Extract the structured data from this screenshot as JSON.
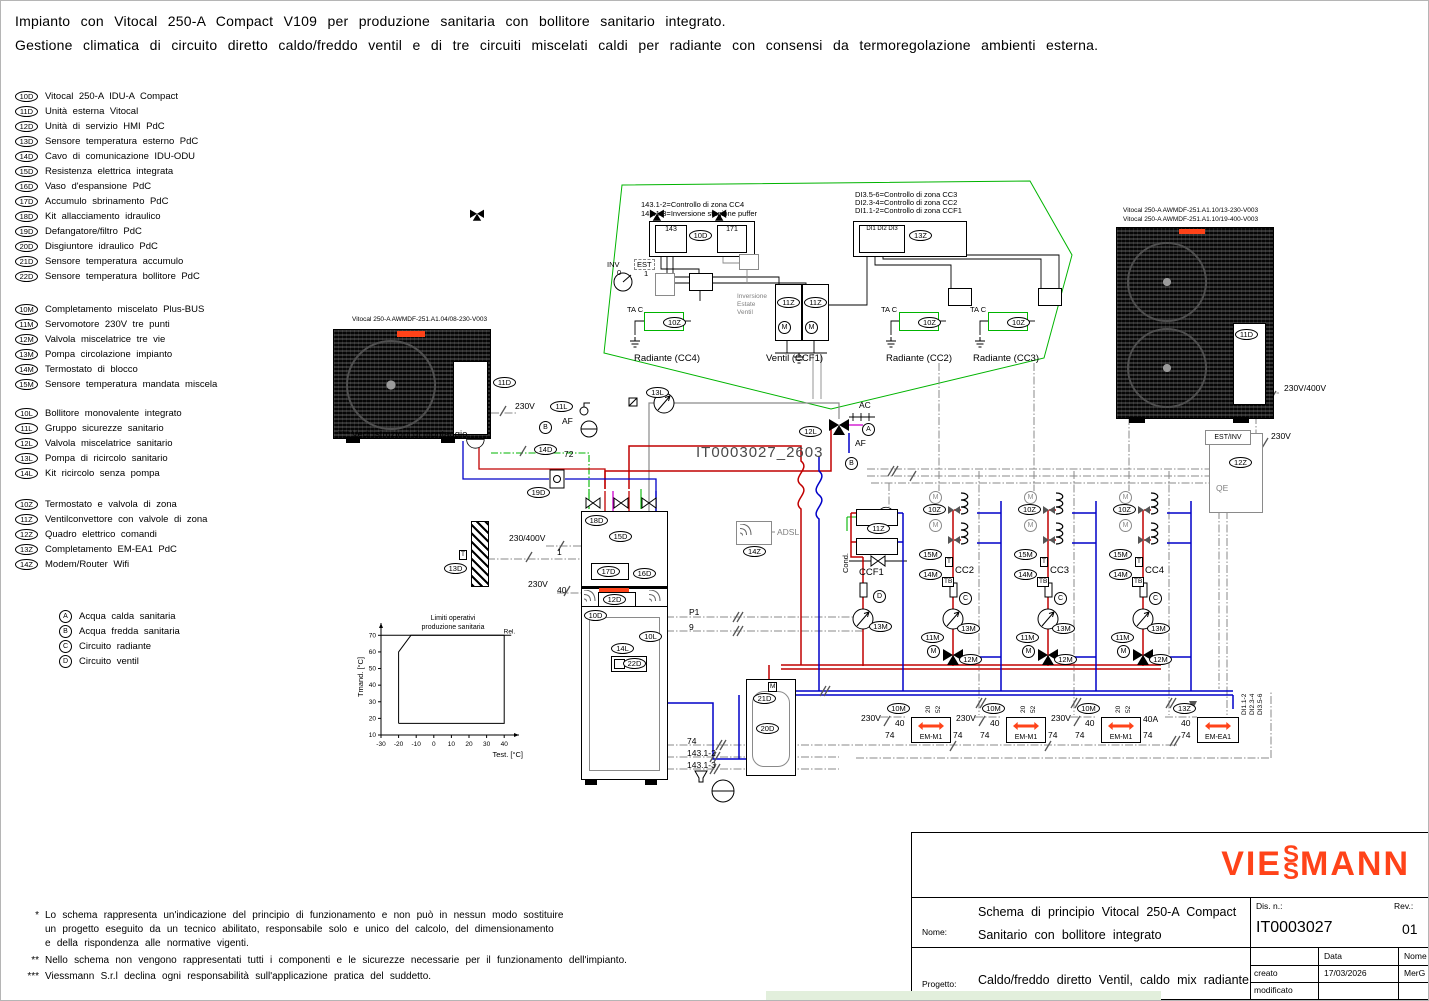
{
  "header": {
    "line1": "Impianto con Vitocal 250-A Compact V109 per produzione sanitaria con bollitore sanitario integrato.",
    "line2": "Gestione climatica di circuito diretto caldo/freddo ventil e di tre circuiti miscelati caldi per radiante con consensi da termoregolazione ambienti esterna."
  },
  "colors": {
    "accent": "#ff4319",
    "pipe_hot": "#cc0000",
    "pipe_cold": "#0000cc",
    "bus_green": "#00b400",
    "control_gray": "#8a8a8a",
    "highlight": "#e2efdc"
  },
  "legend": {
    "d_items": [
      {
        "id": "10D",
        "label": "Vitocal 250-A IDU-A Compact"
      },
      {
        "id": "11D",
        "label": "Unità esterna Vitocal"
      },
      {
        "id": "12D",
        "label": "Unità di servizio HMI PdC"
      },
      {
        "id": "13D",
        "label": "Sensore temperatura esterno PdC"
      },
      {
        "id": "14D",
        "label": "Cavo di comunicazione IDU-ODU"
      },
      {
        "id": "15D",
        "label": "Resistenza elettrica integrata"
      },
      {
        "id": "16D",
        "label": "Vaso d'espansione PdC"
      },
      {
        "id": "17D",
        "label": "Accumulo sbrinamento PdC"
      },
      {
        "id": "18D",
        "label": "Kit allacciamento idraulico"
      },
      {
        "id": "19D",
        "label": "Defangatore/filtro PdC"
      },
      {
        "id": "20D",
        "label": "Disgiuntore idraulico PdC"
      },
      {
        "id": "21D",
        "label": "Sensore temperatura accumulo"
      },
      {
        "id": "22D",
        "label": "Sensore temperatura bollitore PdC"
      }
    ],
    "m_items": [
      {
        "id": "10M",
        "label": "Completamento miscelato Plus-BUS"
      },
      {
        "id": "11M",
        "label": "Servomotore 230V tre punti"
      },
      {
        "id": "12M",
        "label": "Valvola miscelatrice tre vie"
      },
      {
        "id": "13M",
        "label": "Pompa circolazione impianto"
      },
      {
        "id": "14M",
        "label": "Termostato di blocco"
      },
      {
        "id": "15M",
        "label": "Sensore temperatura mandata miscela"
      }
    ],
    "l_items": [
      {
        "id": "10L",
        "label": "Bollitore monovalente integrato"
      },
      {
        "id": "11L",
        "label": "Gruppo sicurezze sanitario"
      },
      {
        "id": "12L",
        "label": "Valvola miscelatrice sanitario"
      },
      {
        "id": "13L",
        "label": "Pompa di ricircolo sanitario"
      },
      {
        "id": "14L",
        "label": "Kit ricircolo senza pompa"
      }
    ],
    "z_items": [
      {
        "id": "10Z",
        "label": "Termostato e valvola di zona"
      },
      {
        "id": "11Z",
        "label": "Ventilconvettore con valvole di zona"
      },
      {
        "id": "12Z",
        "label": "Quadro elettrico comandi"
      },
      {
        "id": "13Z",
        "label": "Completamento EM-EA1 PdC"
      },
      {
        "id": "14Z",
        "label": "Modem/Router Wifi"
      }
    ],
    "letter_items": [
      {
        "id": "A",
        "label": "Acqua calda sanitaria"
      },
      {
        "id": "B",
        "label": "Acqua fredda sanitaria"
      },
      {
        "id": "C",
        "label": "Circuito radiante"
      },
      {
        "id": "D",
        "label": "Circuito ventil"
      }
    ]
  },
  "badges": {
    "d10": "10D",
    "d11": "11D",
    "d12": "12D",
    "d13": "13D",
    "d14": "14D",
    "d15": "15D",
    "d16": "16D",
    "d17": "17D",
    "d18": "18D",
    "d19": "19D",
    "d20": "20D",
    "d21": "21D",
    "d22": "22D",
    "m10": "10M",
    "m11": "11M",
    "m12": "12M",
    "m13": "13M",
    "m14": "14M",
    "m15": "15M",
    "l10": "10L",
    "l11": "11L",
    "l12": "12L",
    "l13": "13L",
    "l14": "14L",
    "z10": "10Z",
    "z11": "11Z",
    "z12": "12Z",
    "z13": "13Z",
    "z14": "14Z"
  },
  "sym": {
    "m": "M",
    "t": "T",
    "tb": "TB",
    "a": "A",
    "b": "B",
    "c": "C",
    "d": "D"
  },
  "schematic": {
    "watermark": "IT0003027_2603",
    "left_odu_caption": "Vitocal 250-A AWMDF-251.A1.04/08-230-V003",
    "right_odu_caption1": "Vitocal 250-A AWMDF-251.A1.10/13-230-V003",
    "right_odu_caption2": "Vitocal 250-A AWMDF-251.A1.10/19-400-V003",
    "mount_note": "*** Vedi istruzioni di montaggio",
    "labels": {
      "v230": "230V",
      "v230_400": "230/400V",
      "v230v400": "230V/400V",
      "n72": "72",
      "n74": "74",
      "n40": "40",
      "n40a": "40A",
      "n1": "1",
      "n9": "9",
      "p1": "P1",
      "n143_12": "143.1-2",
      "n143_13": "143.1-3",
      "ac": "AC",
      "af": "AF",
      "adsl": "ADSL",
      "est_inv": "EST/INV",
      "qe": "QE",
      "cond": "Cond.",
      "em_m1": "EM-M1",
      "em_ea1": "EM-EA1",
      "di1": "DI1.1-2",
      "di2": "DI2.3-4",
      "di3": "DI3.5-6",
      "t20": "20",
      "t52": "52"
    },
    "control": {
      "note1": "143.1-2=Controllo di zona CC4",
      "note2": "143.1-3=Inversione stagione puffer",
      "note3": "DI3.5-6=Controllo di zona CC3",
      "note4": "DI2.3-4=Controllo di zona CC2",
      "note5": "DI1.1-2=Controllo di zona CCF1",
      "b143": "143",
      "b171": "171",
      "bdi": "DI1 DI2 DI3",
      "inv": "INV",
      "est": "EST",
      "zero": "0",
      "one": "1",
      "inv1": "Inversione",
      "inv2": "Estate",
      "inv3": "Ventil",
      "tac": "TA C",
      "zone_cc4": "Radiante (CC4)",
      "zone_ccf1": "Ventil (CCF1)",
      "zone_cc2": "Radiante (CC2)",
      "zone_cc3": "Radiante (CC3)"
    },
    "zones": {
      "ccf1": "CCF1",
      "cc2": "CC2",
      "cc3": "CC3",
      "cc4": "CC4"
    }
  },
  "chart_data": {
    "type": "area",
    "title": "Limiti operativi produzione sanitaria",
    "title_lines": [
      "Limiti operativi",
      "produzione sanitaria"
    ],
    "xlabel": "Test. [°C]",
    "ylabel": "Tmand. [°C]",
    "x_ticks": [
      -30,
      -20,
      -10,
      0,
      10,
      20,
      30,
      40
    ],
    "y_ticks": [
      10,
      20,
      30,
      40,
      50,
      60,
      70
    ],
    "xlim": [
      -30,
      45
    ],
    "ylim": [
      10,
      75
    ],
    "envelope": [
      [
        -20,
        17
      ],
      [
        -20,
        60
      ],
      [
        -13,
        70
      ],
      [
        40,
        70
      ],
      [
        40,
        17
      ],
      [
        -20,
        17
      ]
    ],
    "max_line_y": 70,
    "annotation": "Rel."
  },
  "notes": {
    "s1": "*",
    "n1a": "Lo schema rappresenta un'indicazione del principio di funzionamento e non può in nessun modo sostituire",
    "n1b": "un progetto eseguito da un tecnico abilitato, responsabile solo e unico del calcolo, del dimensionamento",
    "n1c": "e della rispondenza alle normative vigenti.",
    "s2": "**",
    "n2": "Nello schema non vengono rappresentati tutti i componenti e le sicurezze necessarie per il funzionamento dell'impianto.",
    "s3": "***",
    "n3": "Viessmann S.r.l declina ogni responsabilità sull'applicazione pratica del suddetto."
  },
  "titleblock": {
    "logo_a": "VIE",
    "logo_s1": "S",
    "logo_s2": "S",
    "logo_b": "MANN",
    "nome_label": "Nome:",
    "nome_line1": "Schema di principio Vitocal 250-A Compact",
    "nome_line2": "Sanitario con bollitore integrato",
    "progetto_label": "Progetto:",
    "progetto_value": "Caldo/freddo diretto Ventil, caldo mix radiante",
    "dis_label": "Dis. n.:",
    "dis_value": "IT0003027",
    "rev_label": "Rev.:",
    "rev_value": "01",
    "data_col": "Data",
    "nome_col": "Nome",
    "creato_label": "creato",
    "creato_data": "17/03/2026",
    "creato_nome": "MerG",
    "modificato_label": "modificato"
  }
}
